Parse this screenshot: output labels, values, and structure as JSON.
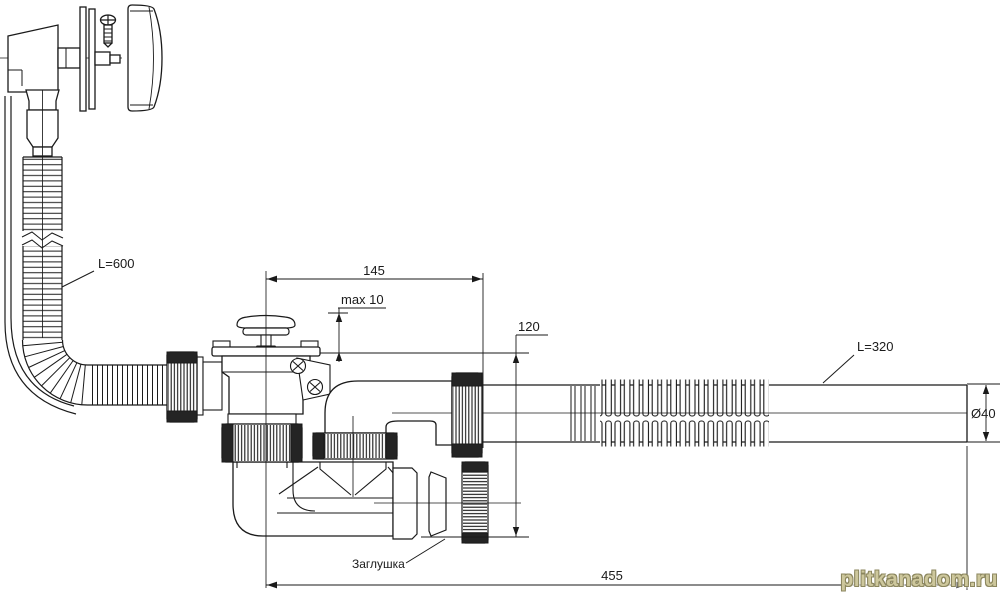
{
  "diagram": {
    "type": "technical-drawing",
    "subject": "bathtub-drain-overflow-siphon-kit",
    "labels": {
      "overflow_hose_length": "L=600",
      "outlet_hose_length": "L=320",
      "dim_width": "145",
      "dim_max_thickness": "max 10",
      "dim_height": "120",
      "dim_total_length": "455",
      "dim_diameter": "Ø40",
      "plug": "Заглушка"
    },
    "watermark": "plitkanadom.ru",
    "colors": {
      "line": "#1a1a1a",
      "background": "#ffffff",
      "watermark_fill": "#cdc79c",
      "watermark_shadow": "#8b865e"
    }
  }
}
